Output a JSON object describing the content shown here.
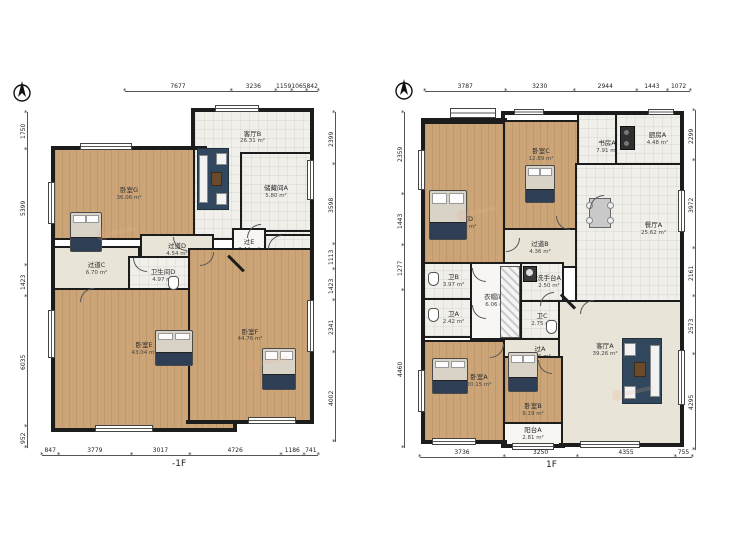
{
  "page": {
    "background": "#ffffff"
  },
  "colors": {
    "wall": "#1c1c1c",
    "wood_floor": "#cba578",
    "tile_floor": "#f1efea",
    "hall_floor": "#e9e4d8",
    "rug": "#31475e",
    "watermark": "#e8a47c"
  },
  "floors": [
    {
      "label": "-1F",
      "compass_icon": "north-compass",
      "rooms": [
        {
          "name": "卧室G",
          "area": "36.06 m²"
        },
        {
          "name": "客厅B",
          "area": "26.31 m²"
        },
        {
          "name": "储藏间A",
          "area": "5.80 m²"
        },
        {
          "name": "过E",
          "area": "2.44 m²"
        },
        {
          "name": "储藏间B",
          "area": "2.33 m²"
        },
        {
          "name": "过道D",
          "area": "4.54 m²"
        },
        {
          "name": "过道C",
          "area": "6.70 m²"
        },
        {
          "name": "卫生间D",
          "area": "4.97 m²"
        },
        {
          "name": "卧室E",
          "area": "43.04 m²"
        },
        {
          "name": "卧室F",
          "area": "44.76 m²"
        }
      ],
      "dims": {
        "top": [
          "7677",
          "3236",
          "1159",
          "1065",
          "842"
        ],
        "bottom": [
          "847",
          "3779",
          "3017",
          "4726",
          "1186",
          "741"
        ],
        "left": [
          "1750",
          "5399",
          "1423",
          "6035",
          "952"
        ],
        "right": [
          "2399",
          "3598",
          "1113",
          "1423",
          "2341",
          "4002"
        ]
      }
    },
    {
      "label": "1F",
      "compass_icon": "north-compass",
      "rooms": [
        {
          "name": "卧室D",
          "area": "21.48 m²"
        },
        {
          "name": "卧室C",
          "area": "12.89 m²"
        },
        {
          "name": "书房A",
          "area": "7.91 m²"
        },
        {
          "name": "厨房A",
          "area": "4.48 m²"
        },
        {
          "name": "餐厅A",
          "area": "25.62 m²"
        },
        {
          "name": "过道B",
          "area": "4.36 m²"
        },
        {
          "name": "卫B",
          "area": "3.97 m²"
        },
        {
          "name": "卫A",
          "area": "2.42 m²"
        },
        {
          "name": "衣帽间A",
          "area": "6.06 m²"
        },
        {
          "name": "洗手台A",
          "area": "2.50 m²"
        },
        {
          "name": "卫C",
          "area": "2.75 m²"
        },
        {
          "name": "过A",
          "area": "3.56 m²"
        },
        {
          "name": "客厅A",
          "area": "39.26 m²"
        },
        {
          "name": "卧室A",
          "area": "20.15 m²"
        },
        {
          "name": "卧室B",
          "area": "9.19 m²"
        },
        {
          "name": "阳台A",
          "area": "2.81 m²"
        }
      ],
      "dims": {
        "top": [
          "3787",
          "3230",
          "2944",
          "1443",
          "1072"
        ],
        "bottom": [
          "3736",
          "3250",
          "4355",
          "755"
        ],
        "left": [
          "2359",
          "1443",
          "1277",
          "4460"
        ],
        "right": [
          "2299",
          "3972",
          "2161",
          "2573",
          "4295"
        ]
      }
    }
  ]
}
